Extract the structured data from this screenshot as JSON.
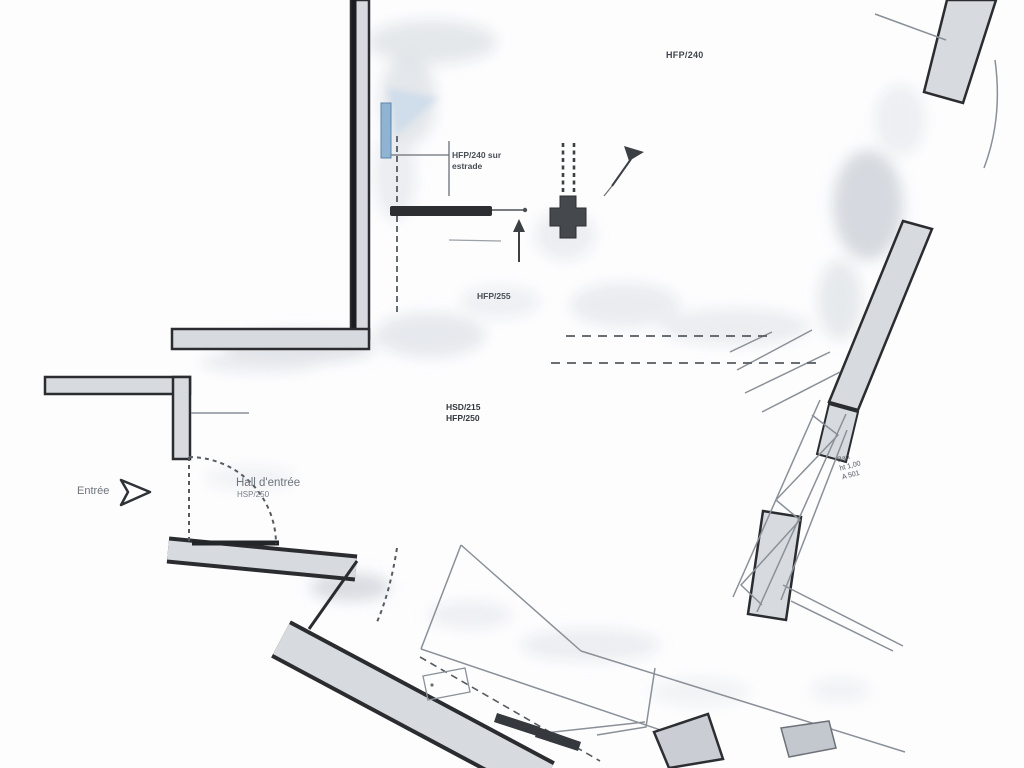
{
  "document": {
    "kind": "scanned architectural floor plan",
    "background": "#fdfdfe"
  },
  "colors": {
    "wall_fill": "#d7dade",
    "wall_edge": "#2a2c30",
    "thin_line": "#8a9098",
    "dash_line": "#565b61",
    "text_dark": "#41454c",
    "text_gray": "#6e747c",
    "blue_marker": "#8fb3d3"
  },
  "labels": {
    "room_top": "HFP/240",
    "estrade_line1": "HFP/240 sur",
    "estrade_line2": "estrade",
    "room_mid": "HFP/255",
    "room_main_line1": "HSD/215",
    "room_main_line2": "HFP/250",
    "hall_line1": "Hall d'entrée",
    "hall_line2": "HSP/250",
    "entrance": "Entrée",
    "bench_line1": "Ban",
    "bench_line2": "ht 1,00",
    "bench_line3": "A 501"
  }
}
